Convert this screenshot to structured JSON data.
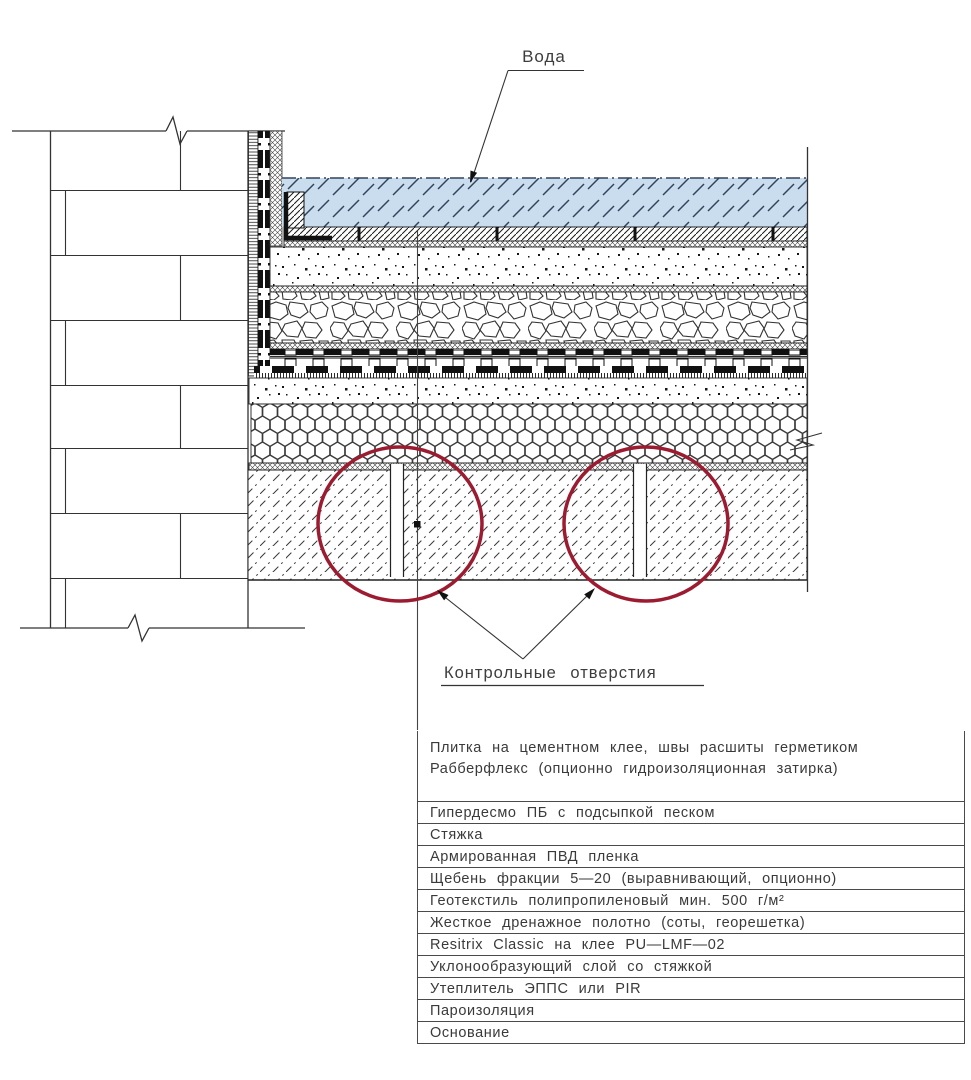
{
  "drawing": {
    "water_label": "Вода",
    "control_holes_label": "Контрольные отверстия"
  },
  "table": {
    "rows": [
      "Плитка на цементном клее, швы расшиты герметиком Рабберфлекс (опционно гидроизоляционная затирка)",
      "Гипердесмо ПБ с подсыпкой песком",
      "Стяжка",
      "Армированная ПВД пленка",
      "Щебень фракции 5—20 (выравнивающий, опционно)",
      "Геотекстиль полипропиленовый мин. 500 г/м²",
      "Жесткое дренажное полотно (соты, георешетка)",
      "Resitrix Classic на клее PU—LMF—02",
      "Уклонообразующий слой со стяжкой",
      "Утеплитель ЭППС или PIR",
      "Пароизоляция",
      "Основание"
    ]
  },
  "colors": {
    "water_fill": "#CADDEF",
    "water_hatch": "#33445A",
    "circle_stroke": "#9C1B30",
    "line": "#333333"
  }
}
